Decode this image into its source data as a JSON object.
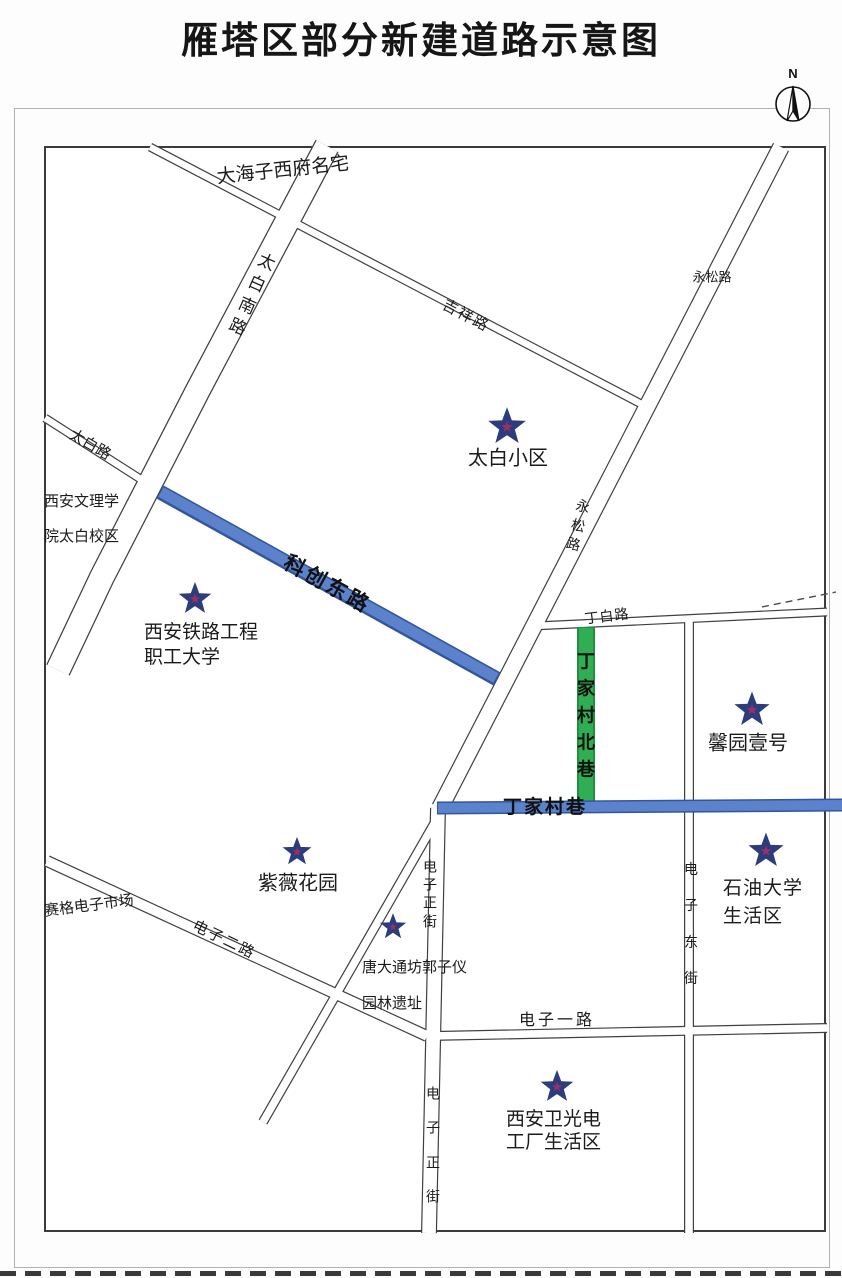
{
  "title": "雁塔区部分新建道路示意图",
  "compass": {
    "label": "N"
  },
  "colors": {
    "new_road_blue": "#5b82cb",
    "new_road_blue_edge": "#33559e",
    "new_road_green": "#2fae54",
    "new_road_green_edge": "#1f9040",
    "star_fill": "#9e2f63",
    "star_stroke": "#2c3c7c"
  },
  "roads": {
    "taibai_south": {
      "label": "太白南路"
    },
    "taibai": {
      "label": "太白路"
    },
    "jixiang": {
      "label": "吉祥路"
    },
    "yongsong": {
      "label": "永松路",
      "label_south": "永松路"
    },
    "kechuang_east": {
      "label": "科创东路"
    },
    "dingbai": {
      "label": "丁白路"
    },
    "dingjiacun_north_lane": {
      "label": "丁家村北巷"
    },
    "dingjiacun_lane": {
      "label": "丁家村巷"
    },
    "dianzi_zhengjie": {
      "label": "电子正街",
      "label_south": "电子正街"
    },
    "dianzi_dongjie": {
      "label": "电子东街"
    },
    "dianzi_yilu": {
      "label": "电子一路"
    },
    "dianzi_erlu": {
      "label": "电子二路"
    }
  },
  "places": {
    "dahaizi": {
      "name": "大海子西府名宅"
    },
    "taibai_estate": {
      "name": "太白小区"
    },
    "wenli_college": {
      "line1": "西安文理学",
      "line2": "院太白校区"
    },
    "railway_college": {
      "line1": "西安铁路工程",
      "line2": "职工大学"
    },
    "xinyuan": {
      "name": "馨园壹号"
    },
    "ziwei_garden": {
      "name": "紫薇花园"
    },
    "saige_market": {
      "name": "赛格电子市场"
    },
    "shiyou_univ": {
      "line1": "石油大学",
      "line2": "生活区"
    },
    "tang_ruins": {
      "line1": "唐大通坊郭子仪",
      "line2": "园林遗址"
    },
    "weiguang": {
      "line1": "西安卫光电",
      "line2": "工厂生活区"
    }
  }
}
